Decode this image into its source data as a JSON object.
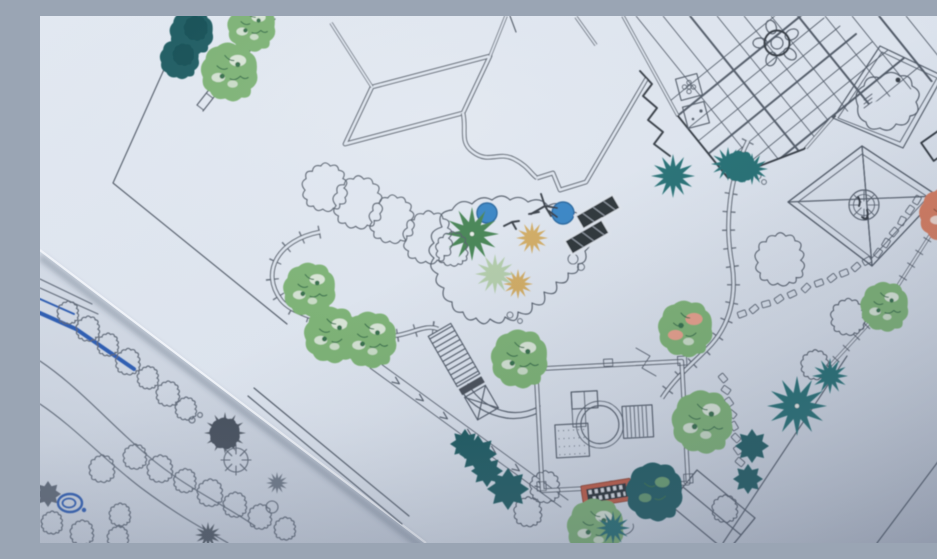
{
  "scene": {
    "subject": "Photograph of two overlapping landscape-architecture plan sheets on a table",
    "camera": "angled top-down photo, plan drawing rotated roughly 40 degrees",
    "visible_text": "none legible",
    "lighting": "soft daylight, shadow deepening toward the bottom corners"
  },
  "sheets": [
    {
      "id": "main-plan",
      "description": "Large coloured master landscape plan on bluish-white paper",
      "features": [
        "house footprint with double-line walls and curved bay",
        "timber pergola patio drawn as a crossing beam grid",
        "round dining table with petal-shaped chairs",
        "square natural pond with amoeba-shaped water outline",
        "square gazebo with crossed diagonals and round centre feature",
        "free-form pond with two blue water circles and tan grass starbursts",
        "two dark solar-lounger panels beside the pond",
        "square pavilion with circular spa, decking hatch and gravel pad",
        "red checkered barbecue mat",
        "gabled shed roof drawn in plan",
        "curved footpaths with tick hatching and a ramp with direction arrows",
        "staircase band, dark landing and small bridge with X brace",
        "stepping-stone trails",
        "boundary fence lines with tick marks",
        "round canopy trees in green, orange and pink-variegated colouring",
        "teal starburst palms and dark leafy shrub masses",
        "scalloped hedge outlines left uncoloured"
      ]
    },
    {
      "id": "under-sketch",
      "description": "Hand-drawn grey-ink planting sketch with blue marker border, visible at the lower-left corner",
      "features": [
        "blue marker title-block border lines",
        "wavy double-line garden path",
        "chains of scalloped shrub scribbles",
        "dark grey spiky tree masses and a radiating bush",
        "blue scribbled pond circle"
      ]
    }
  ],
  "symbol_counts": {
    "green_round_trees": 11,
    "teal_cloud_trees": 2,
    "orange_trees": 2,
    "teal_starburst_palms": 6,
    "tan_grass_starbursts": 2,
    "green_fan_palms": 2,
    "dark_leaf_shrub_masses": 6,
    "uncolored_hedge_clouds": 12,
    "stepping_stones": 25,
    "water_circles": 2,
    "dark_panel_loungers": 2
  },
  "palette": {
    "paper_main": "#dde4ee",
    "paper_main_light": "#e7ecf4",
    "paper_under": "#ccd4e0",
    "ink": "#4d5663",
    "ink_bold": "#2e353d",
    "tree_green": "#79b06f",
    "tree_green_dark": "#2f6b44",
    "tree_green_light": "#c9dcc1",
    "fan_green": "#3d7e4b",
    "fan_green_light": "#a8c79a",
    "teal": "#1c6b6e",
    "teal_dark": "#14565c",
    "orange": "#d4795c",
    "orange_dark": "#8e4a33",
    "tan": "#d0a85c",
    "water_blue": "#2f7fc2",
    "pink_accent": "#e79c87",
    "panel_dark": "#24292f",
    "grill_red": "#c2563c",
    "sketch_blue": "#2b5ab0",
    "sketch_gray": "#5b6573",
    "shadow": "#39445c"
  }
}
